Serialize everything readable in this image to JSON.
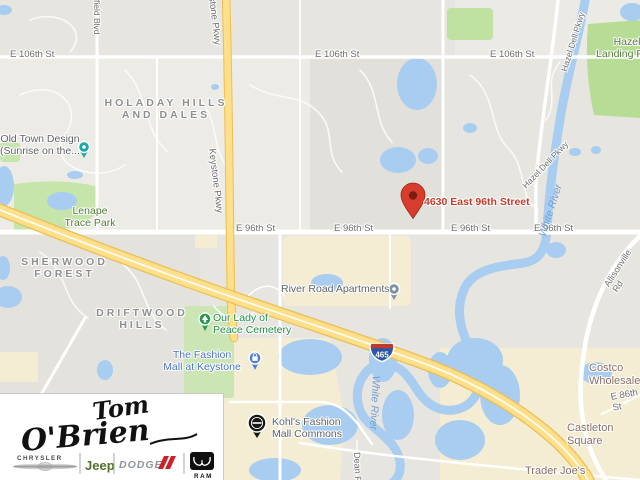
{
  "map": {
    "marker": {
      "address": "4630 East 96th Street"
    },
    "shield": {
      "route": "465"
    },
    "streets": {
      "e106": "E 106th St",
      "e96": "E 96th St",
      "keystone": "Keystone Pkwy",
      "hazel_dell": "Hazel Dell Pkwy",
      "field_blvd": "field Blvd",
      "allisonville": "Allisonville Rd",
      "dean": "Dean Rd",
      "e86": "E 86th St"
    },
    "water_labels": {
      "white_river": "White River"
    },
    "neighborhoods": {
      "holaday": "HOLADAY HILLS\nAND DALES",
      "sherwood": "SHERWOOD\nFOREST",
      "driftwood": "DRIFTWOOD\nHILLS"
    },
    "parks": {
      "lenape": "Lenape\nTrace Park",
      "hazel_landing": "Hazel\nLanding Park"
    },
    "pois": {
      "old_town": "Old Town Design\n(Sunrise on the...",
      "river_road": "River Road Apartments",
      "our_lady": "Our Lady of\nPeace Cemetery",
      "fashion_mall": "The Fashion\nMall at Keystone",
      "kohls": "Kohl's Fashion\nMall Commons",
      "castleton": "Castleton Square",
      "trader_joes": "Trader Joe's",
      "costco": "Costco Wholesale"
    },
    "colors": {
      "marker_red": "#d73c2d",
      "address_red": "#c63a2a",
      "highway_yellow": "#ffe289",
      "water_blue": "#a8cdf0",
      "park_green": "#c6e5ab",
      "commercial_beige": "#f4edd3",
      "poi_blue": "#4a75c9",
      "poi_green": "#1e8e47",
      "shield_blue": "#2a56a5",
      "shield_red": "#bc3a30"
    }
  },
  "logo": {
    "script_first": "Tom",
    "script_last": "O'Brien",
    "brands": {
      "chrysler": "CHRYSLER",
      "jeep": "Jeep",
      "dodge": "DODGE",
      "ram": "RAM"
    },
    "jeep_green": "#55702b",
    "dodge_red": "#cc2229"
  }
}
